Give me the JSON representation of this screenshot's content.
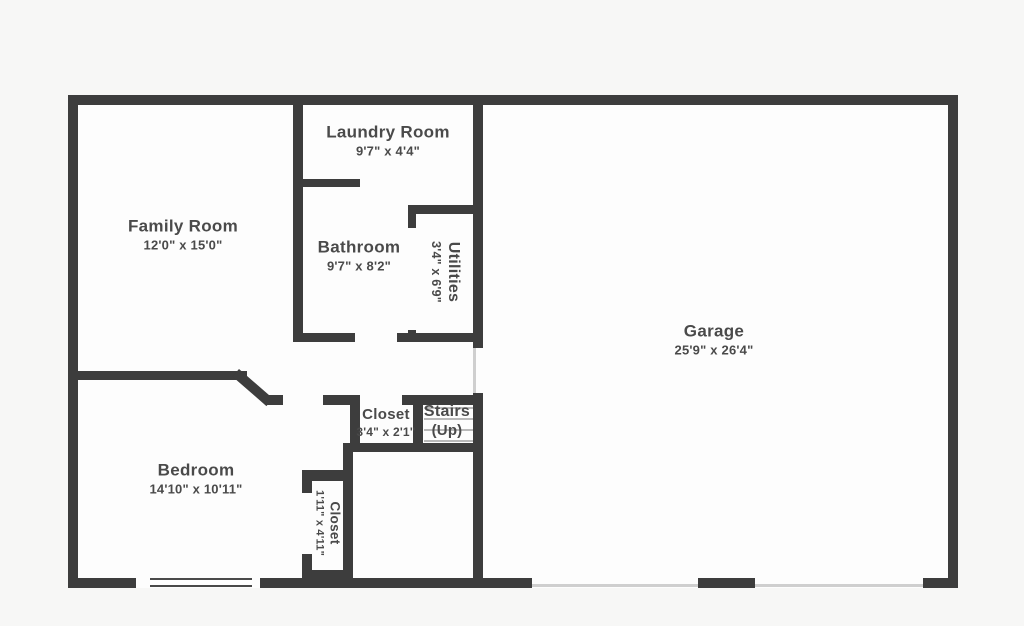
{
  "title": "First floor plan",
  "colors": {
    "wall": "#3d3d3d",
    "floor": "#fdfdfd",
    "background": "#f7f7f6",
    "text": "#4a4a4a",
    "tread": "#b9b9b9",
    "threshold": "#cfcfcf"
  },
  "rooms": [
    {
      "name": "Laundry Room",
      "dims": "9'7\" x 4'4\""
    },
    {
      "name": "Family Room",
      "dims": "12'0\" x 15'0\""
    },
    {
      "name": "Bathroom",
      "dims": "9'7\" x 8'2\""
    },
    {
      "name": "Utilities",
      "dims": "3'4\" x 6'9\"",
      "rotated": true
    },
    {
      "name": "Garage",
      "dims": "25'9\" x 26'4\""
    },
    {
      "name": "Closet",
      "dims": "3'4\" x 2'1\""
    },
    {
      "name": "Stairs",
      "dims": "(Up)"
    },
    {
      "name": "Bedroom",
      "dims": "14'10\" x 10'11\""
    },
    {
      "name": "Closet",
      "dims": "1'11\" x 4'11\"",
      "rotated": true
    }
  ]
}
